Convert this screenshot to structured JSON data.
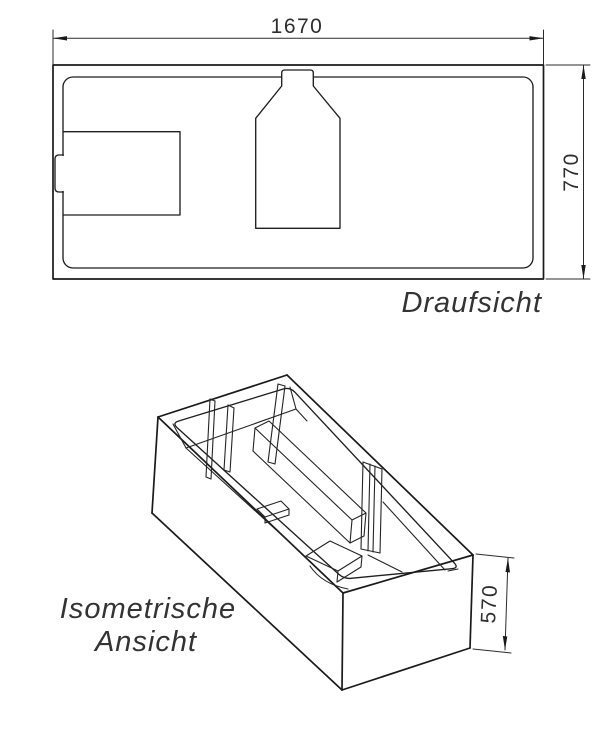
{
  "drawing": {
    "background": "#ffffff",
    "line_color": "#1a1a1a",
    "views": {
      "top_view": {
        "label": "Draufsicht",
        "dimensions": {
          "width": "1670",
          "height": "770"
        }
      },
      "iso_view": {
        "label_line1": "Isometrische",
        "label_line2": "Ansicht",
        "dimensions": {
          "height": "570"
        }
      }
    }
  }
}
